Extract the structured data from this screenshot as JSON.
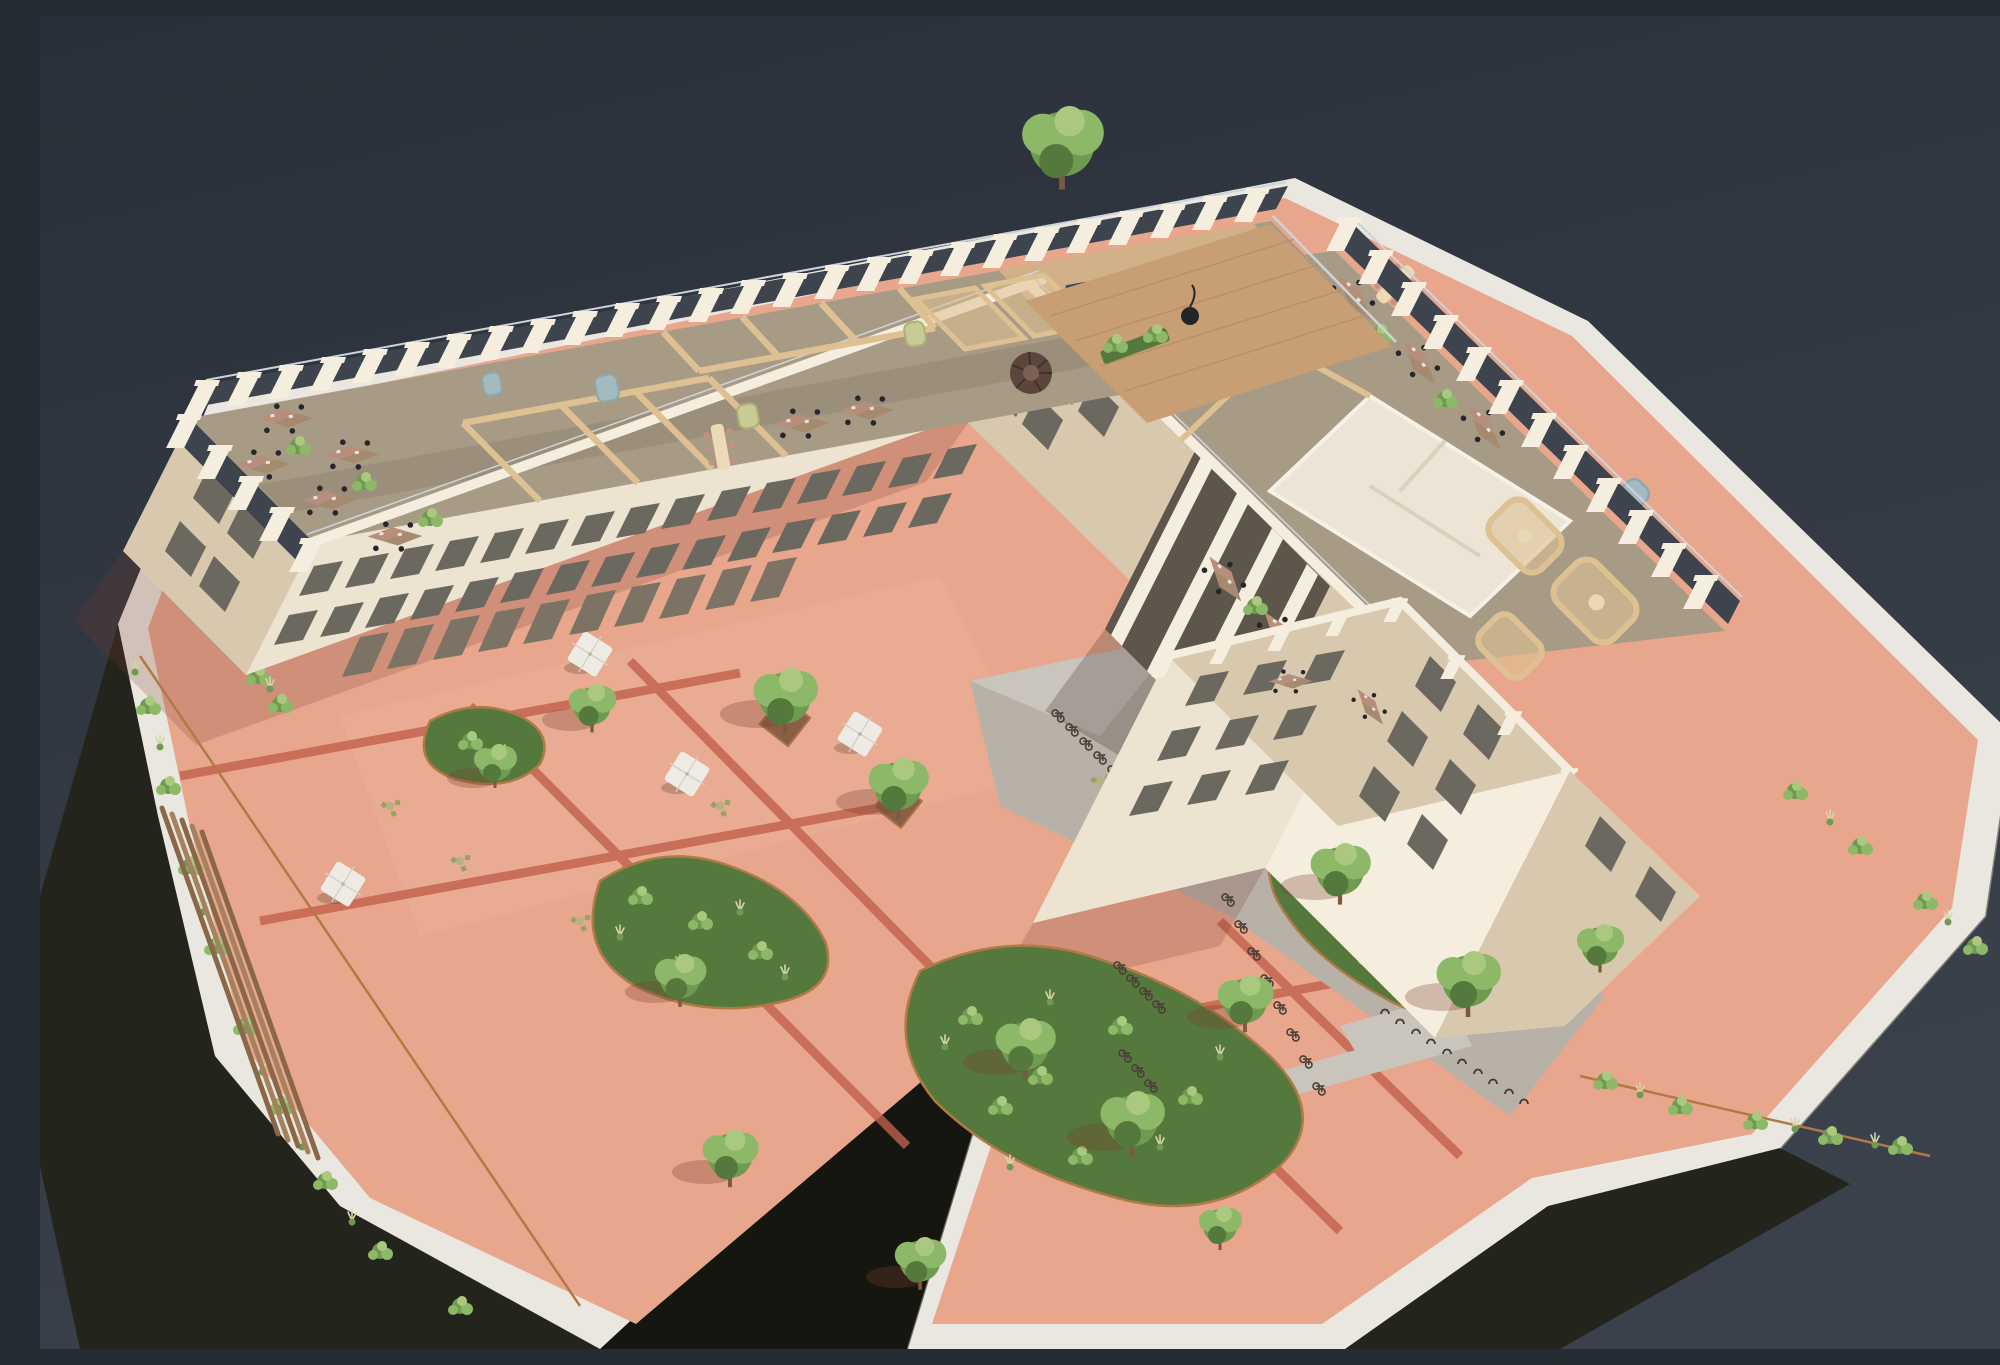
{
  "meta": {
    "title": "Aerial axonometric cutaway rendering of a waterfront office building with a terracotta courtyard",
    "type": "architectural 3D visualization",
    "view": "isometric aerial, top floor cut away to reveal the office plan",
    "time_of_day": "daytime sun from upper right"
  },
  "palette": {
    "bg_top": "#2a3039",
    "bg_bottom": "#3a414b",
    "plinth_top": "#eae7e1",
    "plinth_face": "#23241b",
    "plinth_face2": "#15160f",
    "corten": "#b07a45",
    "pink": "#e8a78d",
    "pink_shade": "#d08d77",
    "band_red": "#c2604b",
    "concrete": "#b7b1a8",
    "concrete_light": "#cac5bc",
    "cream": "#ece3d1",
    "cream_lit": "#f5eedf",
    "cream_shade": "#d8c9ae",
    "glass_dark": "#3d444d",
    "glass_streak": "#ccd4d9",
    "window_glass": "#6b685f",
    "door_glass": "#7c7365",
    "window_lit": "#e3cf9a",
    "carpet": "#a89b86",
    "carpet_dark": "#8f8371",
    "wood_floor": "#d2b189",
    "wood_wall": "#dec192",
    "wood_wall_dark": "#c5a472",
    "desk": "#b78e7c",
    "desk2": "#a58a70",
    "chair": "#26262b",
    "pod_blue": "#a3bac0",
    "pod_green": "#c8cb93",
    "navy": "#3c4856",
    "olive": "#8f9156",
    "stair": "#5c463c",
    "green1": "#55793c",
    "green2": "#6f9b50",
    "green3": "#8cb868",
    "green4": "#aac97f",
    "grass_pale": "#d8d3ab",
    "trunk": "#7a5b40",
    "umbrella": "#edebe4",
    "water_jet": "#f2f6f7",
    "deck_wood": "#c89f74",
    "shadow_warm": "rgba(123,58,44,0.22)"
  },
  "scene": {
    "background": "dark slate water",
    "site": {
      "plinth": "white concrete plinth rising from dark water",
      "paving": "terracotta pink pavers with red banding strips",
      "paths": "grey concrete route through the covered passage",
      "edge_planting": "native grasses and shrubs in corten-edged beds"
    },
    "building": {
      "wings": [
        "north wing",
        "east wing",
        "south-east tower"
      ],
      "facade": "cream precast frame, castellated parapet with glass balustrade",
      "top_floor": "cut away to reveal timber-partitioned offices",
      "courtyard_floors_visible": 3,
      "parapet_piers_north": 26,
      "parapet_piers_east": 12,
      "parapet_piers_west": 5
    },
    "interior": {
      "floor": "taupe carpet with oak boards in the social zone",
      "partitions": "light oak walls and curved meeting pods",
      "furniture": [
        "workstations with black task chairs",
        "long meeting tables with blush chairs",
        "acoustic booths",
        "green lounge sofas",
        "white kitchen island",
        "navy kitchen counter"
      ],
      "phone_booths": [
        {
          "color_name": "blue-grey",
          "count": 3
        },
        {
          "color_name": "green",
          "count": 2
        }
      ],
      "spiral_staircases": 1,
      "white_core_rooms": 1
    },
    "courtyard": {
      "trees": 14,
      "parasols": 5,
      "cafe_sets": 6,
      "fountain_jets": 5,
      "bicycles": 20,
      "empty_bike_hoops": 10,
      "stepped_timber_seating_steps": 5
    },
    "roof_terrace": {
      "location": "north-east corner",
      "features": [
        "large tree",
        "timber deck",
        "black hanging chair",
        "glass railing",
        "planter boxes"
      ]
    }
  }
}
